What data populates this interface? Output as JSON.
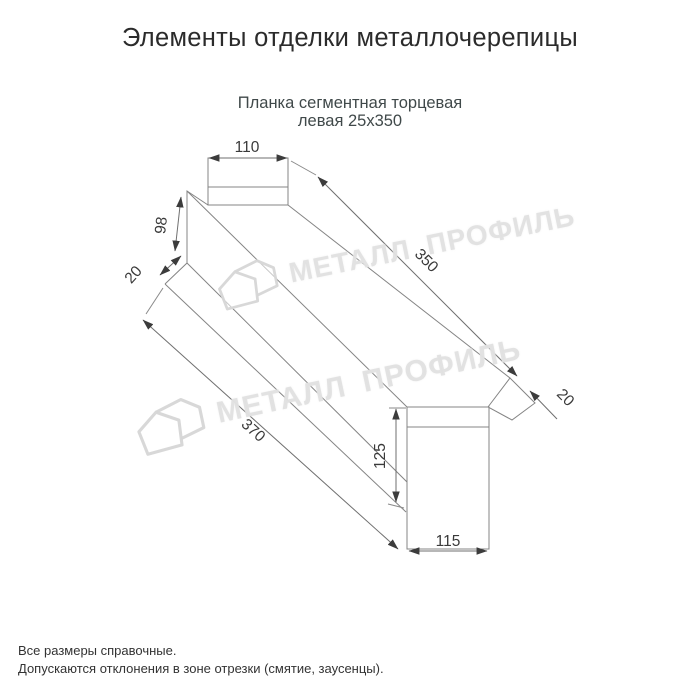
{
  "page": {
    "title": "Элементы отделки металлочерепицы"
  },
  "product": {
    "name_line1": "Планка сегментная торцевая",
    "name_line2": "левая 25х350"
  },
  "drawing": {
    "type": "technical-dimension-drawing",
    "dimensions": {
      "top_width": "110",
      "left_height": "98",
      "left_flange": "20",
      "length_top": "350",
      "right_flange": "20",
      "length_bottom": "370",
      "right_height": "125",
      "bottom_width": "115"
    }
  },
  "watermark": {
    "text": "МЕТАЛЛ ПРОФИЛЬ",
    "logo": "metalprofil-house-logo"
  },
  "footer": {
    "note1": "Все размеры справочные.",
    "note2": "Допускаются отклонения в зоне отрезки (смятие, заусенцы)."
  },
  "colors": {
    "background": "#ffffff",
    "drawing_line": "#848484",
    "dimension_text": "#3a3a3a",
    "title_text": "#2b2b2b",
    "subtitle_text": "#40494a",
    "watermark": "#dfdfdf"
  }
}
